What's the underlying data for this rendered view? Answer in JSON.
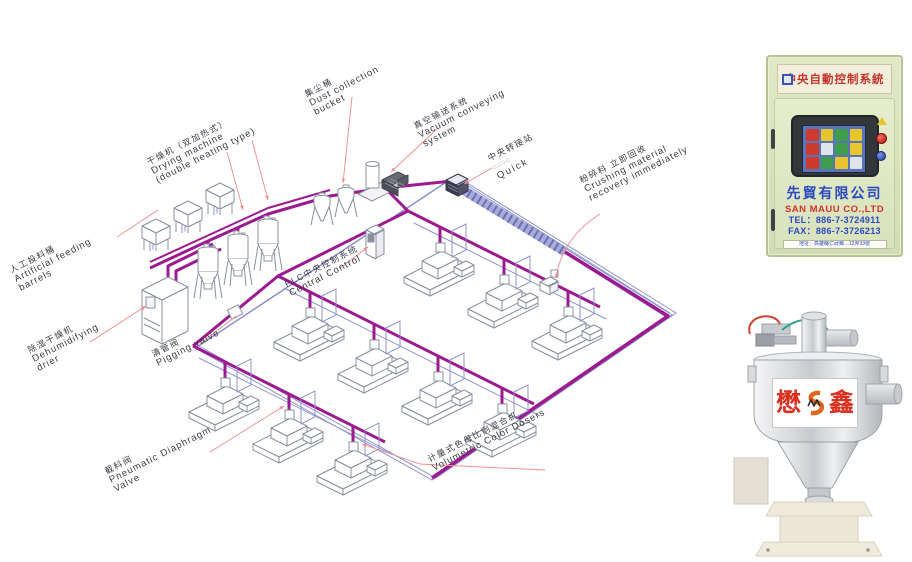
{
  "diagram": {
    "labels": {
      "artificial_feeding": {
        "zh": "人工投料桶",
        "en1": "Artificial feeding",
        "en2": "barrels"
      },
      "drying_machine": {
        "zh": "干燥机（双加热式）",
        "en1": "Drying machine",
        "en2": "(double heating type)"
      },
      "dust_collection": {
        "zh": "集尘桶",
        "en1": "Dust collection",
        "en2": "bucket"
      },
      "vacuum_conveying": {
        "zh": "真空输送系统",
        "en1": "Vacuum conveying",
        "en2": "system"
      },
      "transfer_station": {
        "zh": "中央转接站",
        "sub": "□□□□",
        "en1": "Quick"
      },
      "plc_control": {
        "zh": "PLC中央控制系统",
        "en1": "Central Control"
      },
      "crushing_recovery": {
        "zh": "粉碎料 立即回收",
        "en1": "Crushing material",
        "en2": "recovery immediately"
      },
      "dehumidifying_drier": {
        "zh": "除湿干燥机",
        "en1": "Dehumidifying",
        "en2": "drier"
      },
      "pigging_valve": {
        "zh": "清管阀",
        "en1": "Pigging valve"
      },
      "pneumatic_diaphragm_valve": {
        "zh": "截料阀",
        "en1": "Pneumatic Diaphragm",
        "en2": "Valve"
      },
      "volumetric_color_dosers": {
        "zh": "计量式色母比例混合机",
        "en1": "Volumetric Color Dosers"
      }
    },
    "colors": {
      "pipe": "#9c1a90",
      "vacuum_line": "#8d92cc",
      "leader": "#ee8c8c",
      "line_art": "#8a90a0"
    }
  },
  "control_cabinet": {
    "header": "中央自動控制系統",
    "company_zh": "先貿有限公司",
    "company_en": "SAN MAUU CO.,LTD",
    "tel": "TEL：886-7-3724911",
    "fax": "FAX：886-7-3726213",
    "address": "地址：高雄縣仁武鄉…12弄33號",
    "screen_cells": [
      "#cc3b2e",
      "#e6c52f",
      "#3f9e4d",
      "#e6c52f",
      "#cc3b2e",
      "#dfe3ea",
      "#3f9e4d",
      "#e6c52f",
      "#cc3b2e",
      "#3f9e4d",
      "#e6c52f",
      "#dfe3ea"
    ]
  },
  "hopper_loader": {
    "brand_left": "懋",
    "brand_right": "鑫"
  }
}
